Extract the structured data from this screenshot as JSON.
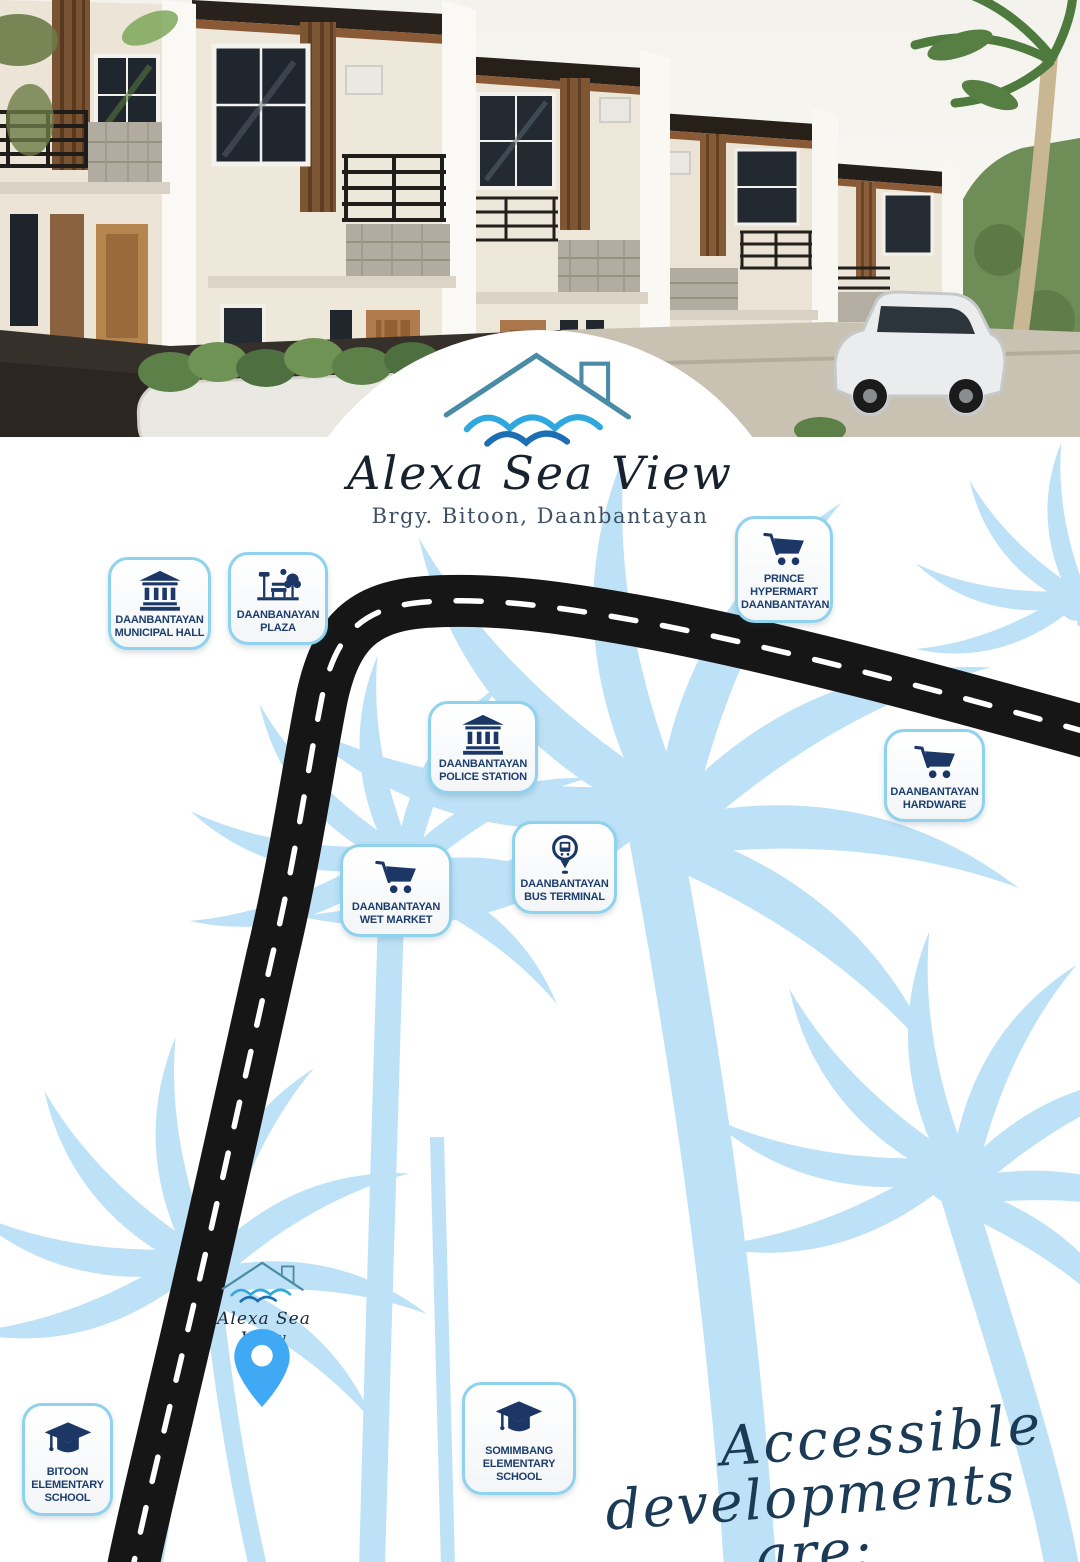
{
  "brand": {
    "name": "Alexa Sea View",
    "location": "Brgy. Bitoon, Daanbantayan"
  },
  "map": {
    "markers": [
      {
        "id": "municipal-hall",
        "label": "DAANBANTAYAN\nMUNICIPAL HALL",
        "icon": "government-building-icon"
      },
      {
        "id": "plaza",
        "label": "DAANBANAYAN\nPLAZA",
        "icon": "park-icon"
      },
      {
        "id": "prince-hypermart",
        "label": "PRINCE\nHYPERMART\nDAANBANTAYAN",
        "icon": "shopping-cart-icon"
      },
      {
        "id": "police-station",
        "label": "DAANBANTAYAN\nPOLICE STATION",
        "icon": "government-building-icon"
      },
      {
        "id": "hardware",
        "label": "DAANBANTAYAN\nHARDWARE",
        "icon": "shopping-cart-icon"
      },
      {
        "id": "bus-terminal",
        "label": "DAANBANTAYAN\nBUS TERMINAL",
        "icon": "bus-pin-icon"
      },
      {
        "id": "wet-market",
        "label": "DAANBANTAYAN\nWET MARKET",
        "icon": "shopping-cart-icon"
      },
      {
        "id": "bitoon-school",
        "label": "BITOON\nELEMENTARY\nSCHOOL",
        "icon": "graduation-cap-icon"
      },
      {
        "id": "somimbang-school",
        "label": "SOMIMBANG\nELEMENTARY\nSCHOOL",
        "icon": "graduation-cap-icon"
      }
    ],
    "site_label": "Alexa Sea View",
    "tagline_line1": "Accessible",
    "tagline_line2": "developments are:"
  },
  "colors": {
    "palm_blue": "#BDE1F6",
    "road_black": "#161616",
    "badge_border": "#8ED2EE",
    "badge_text_navy": "#1D3E6D",
    "icon_navy": "#1C3765",
    "pin_blue": "#3FA9F5",
    "wave_light_blue": "#2FA8DF",
    "wave_dark_blue": "#1E6FB2",
    "roof_teal": "#4A8CA6",
    "tagline_navy": "#1B3A55"
  }
}
